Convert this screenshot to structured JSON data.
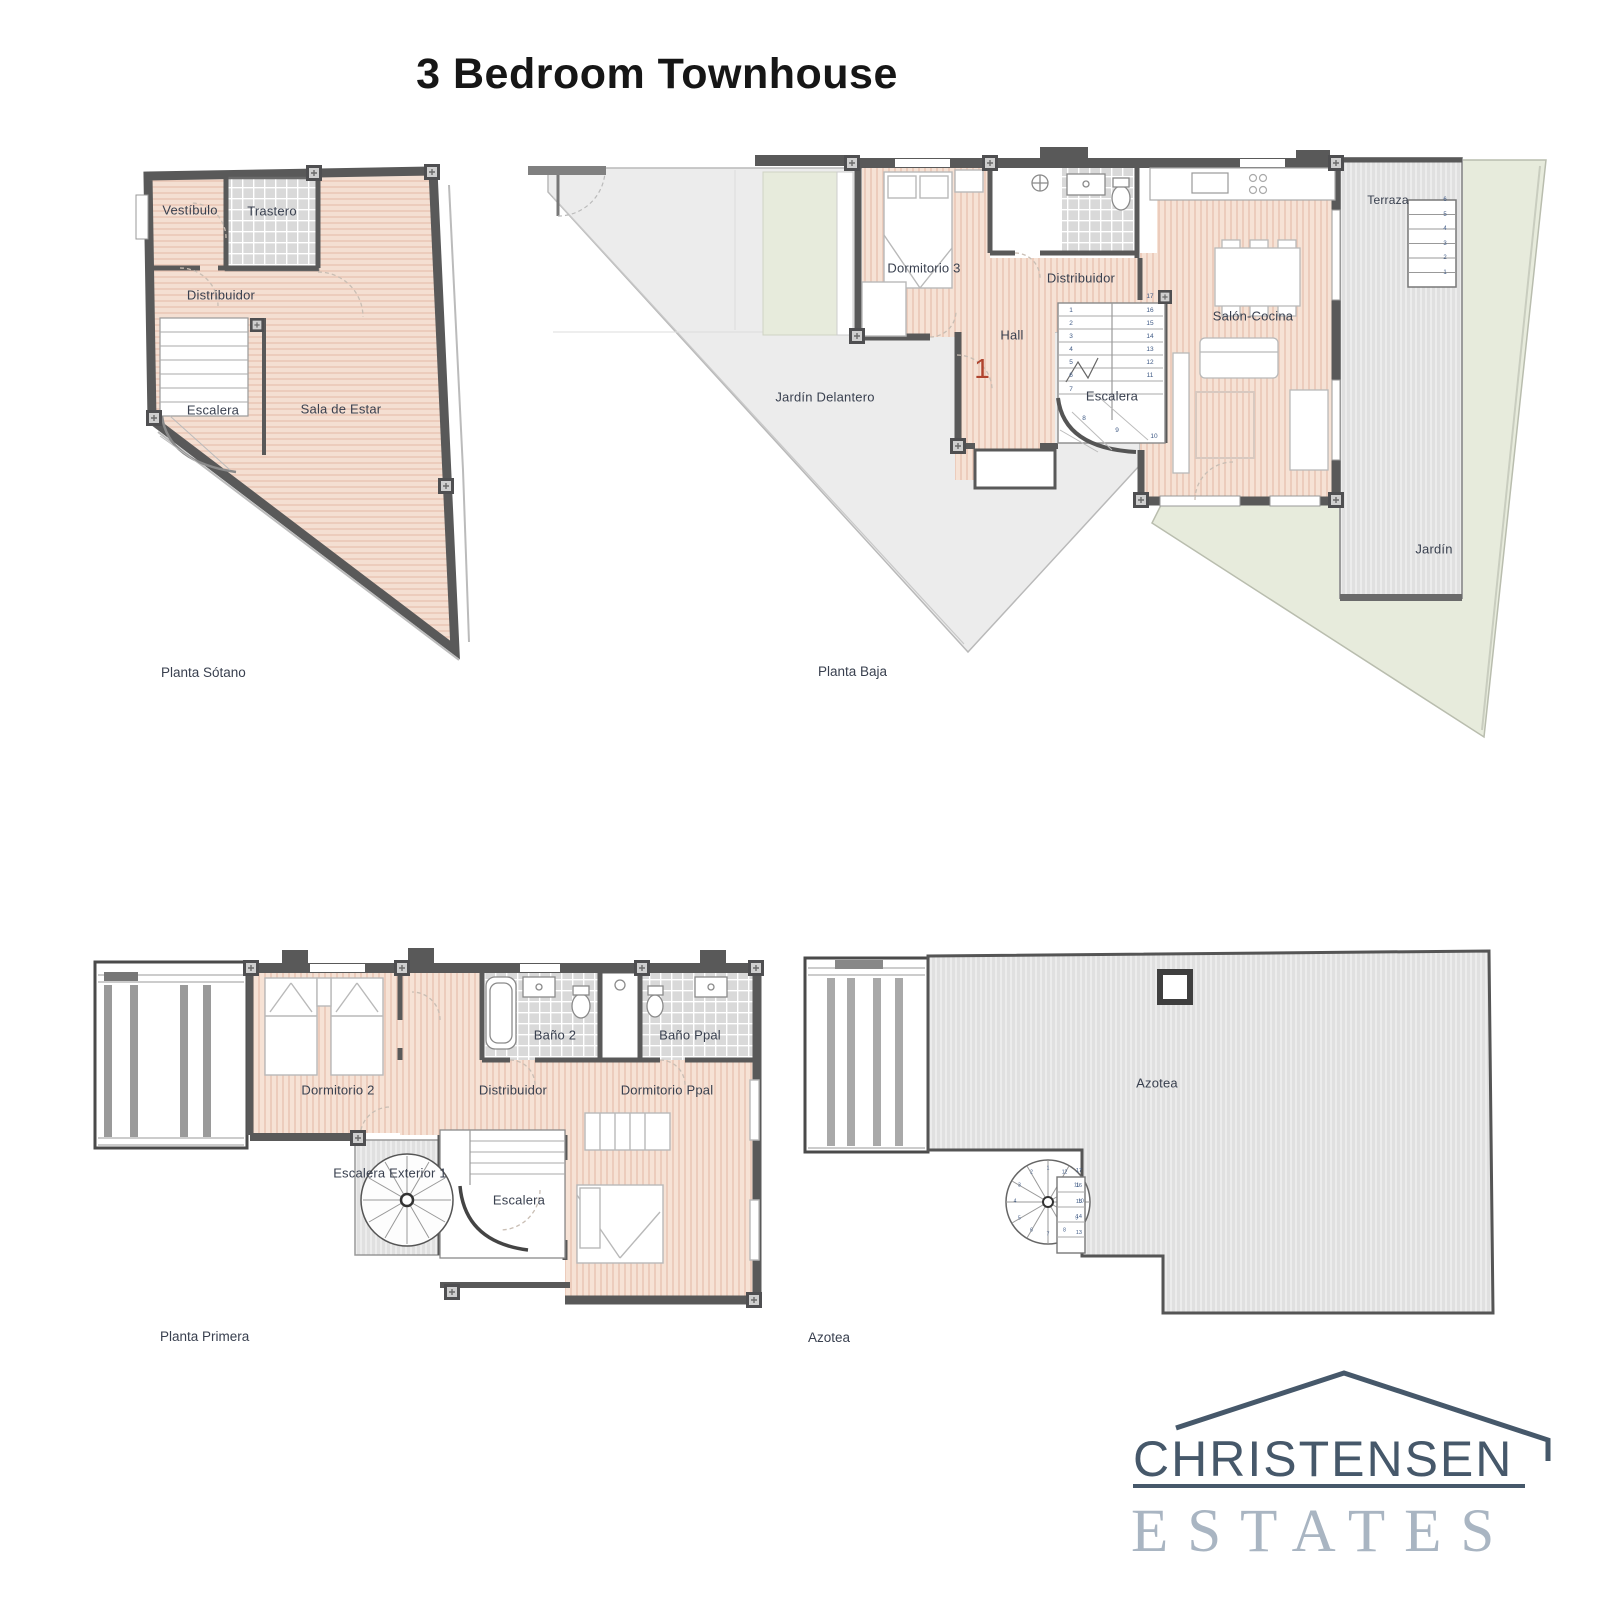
{
  "title": "3 Bedroom Townhouse",
  "plans": {
    "sotano": {
      "caption": "Planta Sótano",
      "rooms": {
        "vestibulo": "Vestíbulo",
        "trastero": "Trastero",
        "distribuidor": "Distribuidor",
        "escalera": "Escalera",
        "sala": "Sala de Estar"
      }
    },
    "baja": {
      "caption": "Planta Baja",
      "rooms": {
        "dormitorio3": "Dormitorio 3",
        "distribuidor": "Distribuidor",
        "hall": "Hall",
        "escalera": "Escalera",
        "salon": "Salón-Cocina",
        "terraza": "Terraza",
        "jardin_delantero": "Jardín Delantero",
        "jardin": "Jardín"
      },
      "unit_number": "1",
      "stairs": {
        "left_column": [
          "1",
          "2",
          "3",
          "4",
          "5",
          "6",
          "7"
        ],
        "right_column": [
          "16",
          "15",
          "14",
          "13",
          "12",
          "11"
        ],
        "top": "17",
        "curve": [
          "8",
          "9",
          "10"
        ]
      },
      "terraza_steps": [
        "6",
        "5",
        "4",
        "3",
        "2",
        "1"
      ]
    },
    "primera": {
      "caption": "Planta Primera",
      "rooms": {
        "dormitorio2": "Dormitorio 2",
        "bano2": "Baño 2",
        "bano_ppal": "Baño Ppal",
        "distribuidor": "Distribuidor",
        "dormitorio_ppal": "Dormitorio Ppal",
        "escalera_exterior": "Escalera Exterior 1",
        "escalera": "Escalera"
      }
    },
    "azotea": {
      "caption": "Azotea",
      "rooms": {
        "azotea": "Azotea"
      },
      "spiral_steps": [
        "1",
        "2",
        "3",
        "4",
        "5",
        "6",
        "7",
        "8",
        "9",
        "10",
        "11",
        "12"
      ],
      "straight_steps": [
        "17",
        "16",
        "15",
        "14",
        "13"
      ]
    }
  },
  "logo": {
    "name": "CHRISTENSEN",
    "division": "ESTATES"
  },
  "colors": {
    "wood_floor": "#f4dfd2",
    "wood_stripe": "#eac7b6",
    "tile_floor": "#d9d9d9",
    "deck": "#e0e0e0",
    "garden": "#e7ebdc",
    "patio": "#ececec",
    "wall": "#595959",
    "label_text": "#39404f",
    "stair_number": "#3f5a85",
    "unit_number_red": "#b0442e",
    "logo_dark": "#46586a",
    "logo_light": "#a9b5c2"
  }
}
